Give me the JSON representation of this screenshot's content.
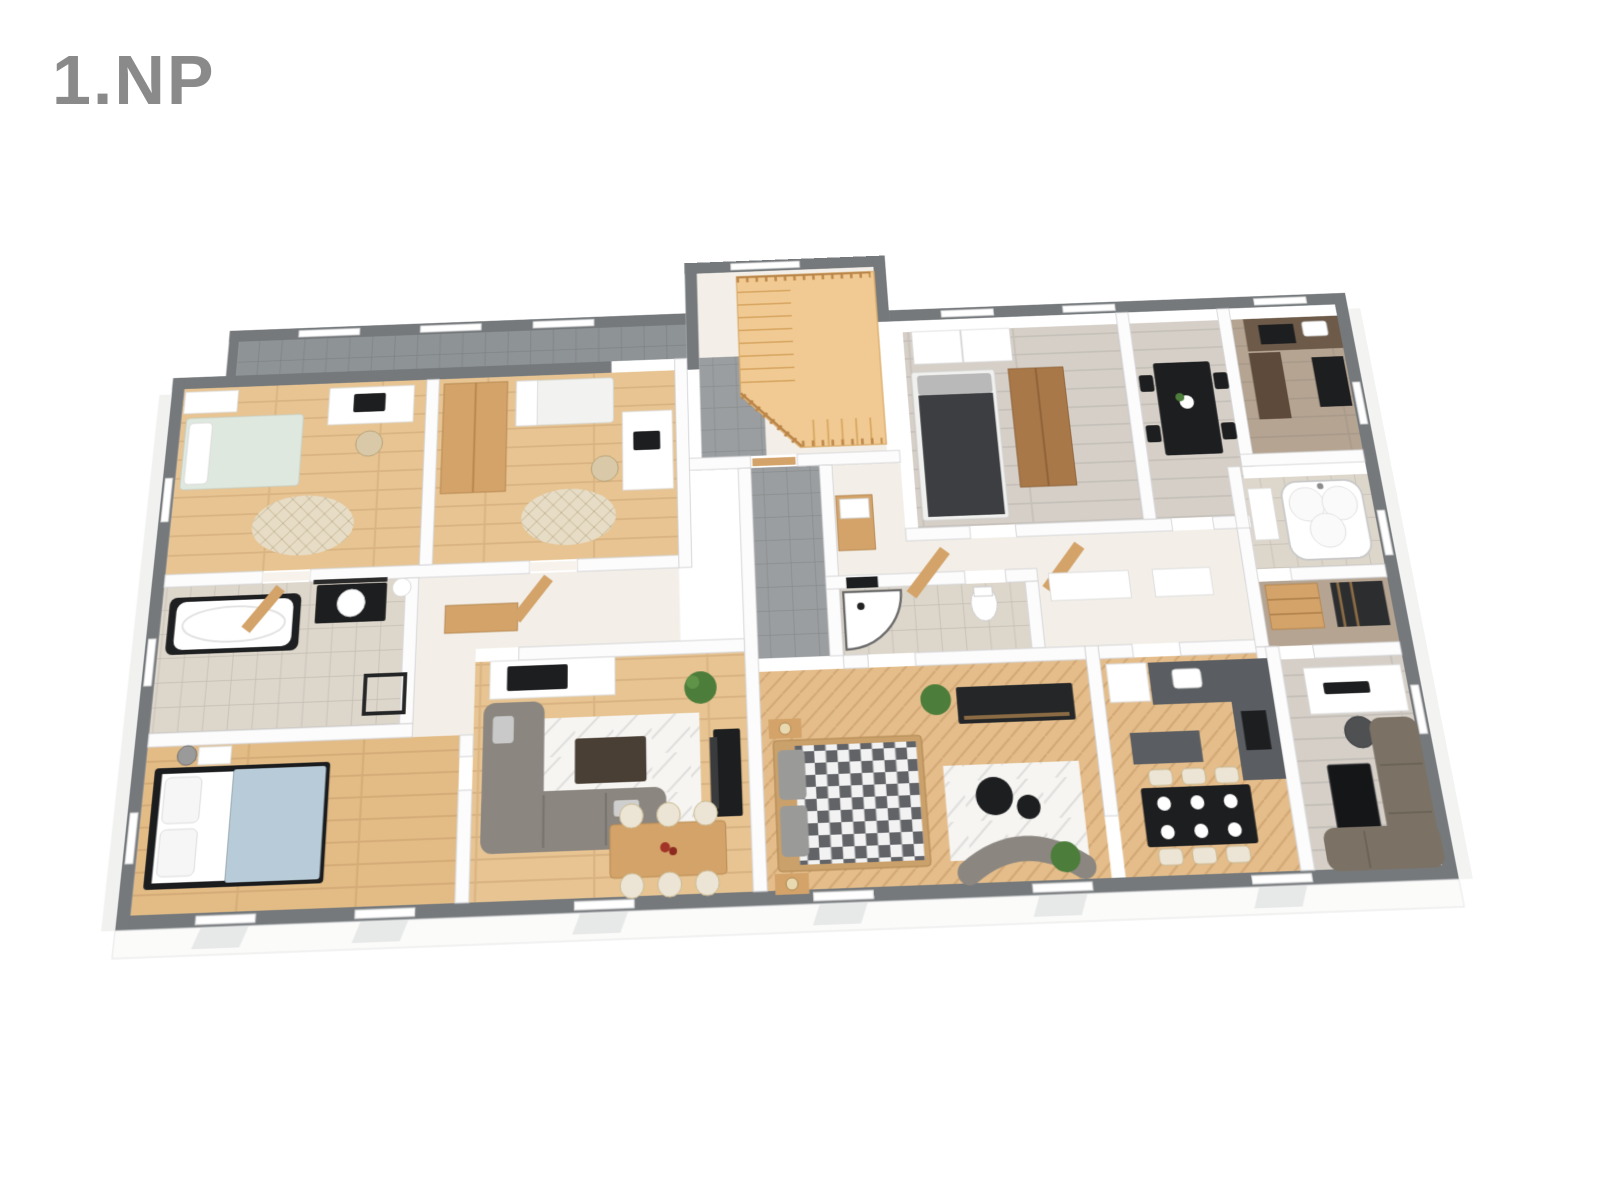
{
  "floor": {
    "title": "1.NP"
  },
  "palette": {
    "title": "#8a8a8a",
    "wall_gray": "#75797c",
    "wall_inner": "#fcfcfd",
    "floor_oak": "#e7c492",
    "floor_oak_deep": "#e2bb85",
    "herr": "#e4bd8b",
    "tile_gray": "#9b9ea0",
    "tile_beige": "#ddd6cb",
    "balcony": "#8e9396",
    "floor_white": "#f3efe8",
    "gray_wood": "#d5cfc7",
    "taupe": "#b5a492",
    "stair_wood": "#f0ca92",
    "black": "#1d1e20",
    "wood": "#d3a369",
    "wood_dark": "#a87848",
    "mint": "#dfe8df",
    "blue": "#b7ccd8",
    "cream": "#ece4d4",
    "counter": "#5a5e62",
    "sofa_gray": "#8b8680",
    "sofa_brown": "#7b7265",
    "rug_white": "#f6f5f2",
    "rug_beige": "#e7ddc6",
    "plant": "#4c7d3a",
    "check_dark": "#616367"
  },
  "rooms": [
    "balcony",
    "kids-room-a",
    "kids-room-b",
    "bathroom-left",
    "bedroom-bottom-left",
    "living-room",
    "staircase-hall",
    "corridor",
    "hallway",
    "shower-room",
    "master-bedroom",
    "kitchen-center",
    "office-tv-room",
    "bedroom-top-right",
    "dining-top-right",
    "kitchen-top-right",
    "bathroom-jacuzzi",
    "closet"
  ]
}
